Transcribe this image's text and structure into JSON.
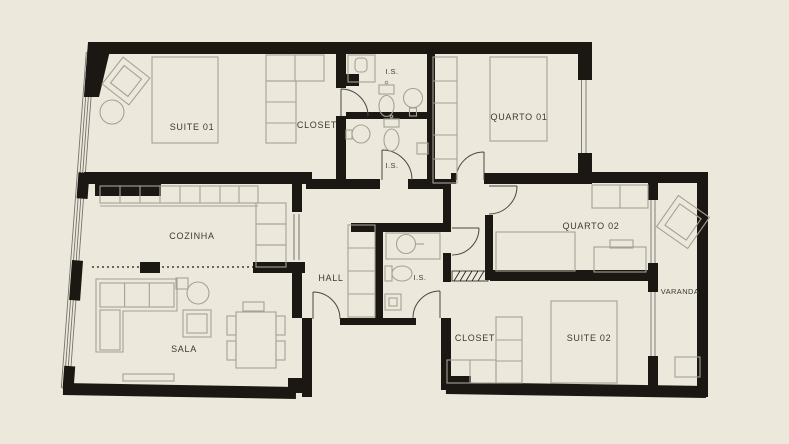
{
  "plan": {
    "colors": {
      "background": "#ece9dc",
      "wall": "#1b1813",
      "furniture": "#a5a195",
      "window": "#75726b",
      "door": "#4a473f",
      "label": "#3c3933"
    },
    "rooms": {
      "suite01": "SUITE 01",
      "closet01": "CLOSET",
      "is_top": "I.S.",
      "is_mid": "I.S.",
      "quarto01": "QUARTO 01",
      "cozinha": "COZINHA",
      "hall": "HALL",
      "is_hall": "I.S.",
      "quarto02": "QUARTO 02",
      "varanda": "VARANDA",
      "sala": "SALA",
      "closet02": "CLOSET",
      "suite02": "SUITE 02"
    }
  }
}
